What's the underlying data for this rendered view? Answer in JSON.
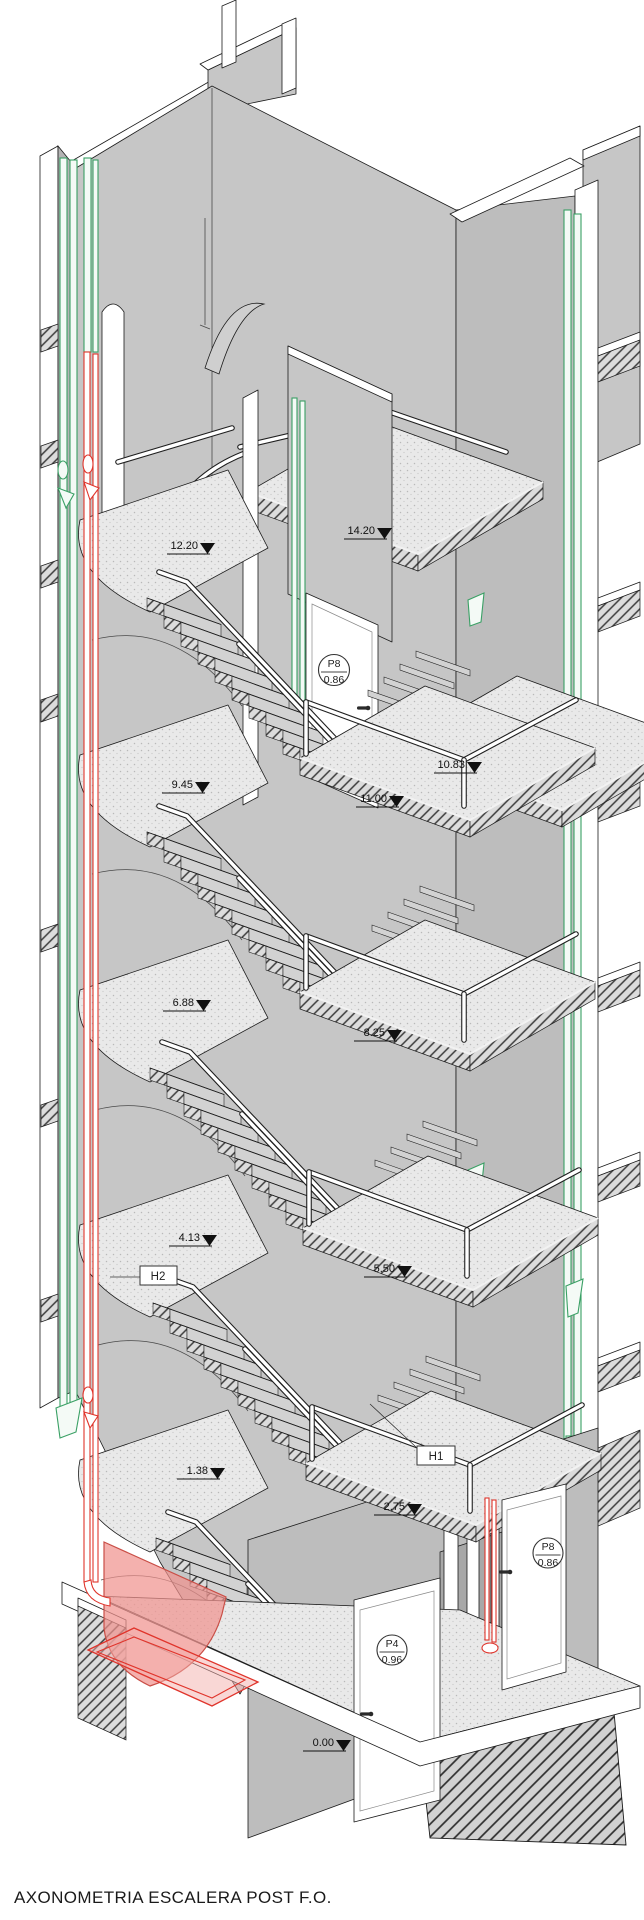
{
  "title": "AXONOMETRIA ESCALERA POST F.O.",
  "colors": {
    "pipe_green": "#3aa065",
    "pipe_red": "#e0342b",
    "highlight_pink": "#f0938f",
    "wall_gray": "#c6c6c6",
    "slab_light": "#e9e9e9"
  },
  "level_markers": [
    {
      "label": "14.20"
    },
    {
      "label": "12.20"
    },
    {
      "label": "10.83"
    },
    {
      "label": "11.00"
    },
    {
      "label": "9.45"
    },
    {
      "label": "8.25"
    },
    {
      "label": "6.88"
    },
    {
      "label": "5.50"
    },
    {
      "label": "4.13"
    },
    {
      "label": "2.75"
    },
    {
      "label": "1.38"
    },
    {
      "label": "0.00"
    }
  ],
  "hall_labels": [
    {
      "label": "H2"
    },
    {
      "label": "H1"
    }
  ],
  "door_labels": [
    {
      "code": "P8",
      "width": "0.86"
    },
    {
      "code": "P8",
      "width": "0.86"
    },
    {
      "code": "P4",
      "width": "0.96"
    }
  ]
}
